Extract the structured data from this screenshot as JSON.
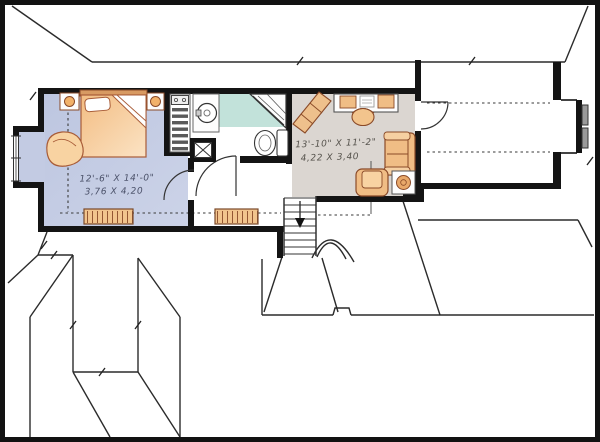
{
  "plan": {
    "type": "second-floor-plan",
    "bedroom": {
      "dim_imperial": "12'-6\" X 14'-0\"",
      "dim_metric": "3,76 X 4,20",
      "floor_color": "#c6cde5"
    },
    "family_room": {
      "dim_imperial": "13'-10\" X 11'-2\"",
      "dim_metric": "4,22 X 3,40",
      "floor_color": "#dbd6d1"
    },
    "bathroom": {
      "floor_color": "#c2e2da"
    },
    "colors": {
      "wall": "#141414",
      "furniture": "#f2c48d",
      "furniture_outline": "#8a4a28",
      "roof_line": "#2b2b2b",
      "window_glass": "#9a9a9a"
    }
  }
}
